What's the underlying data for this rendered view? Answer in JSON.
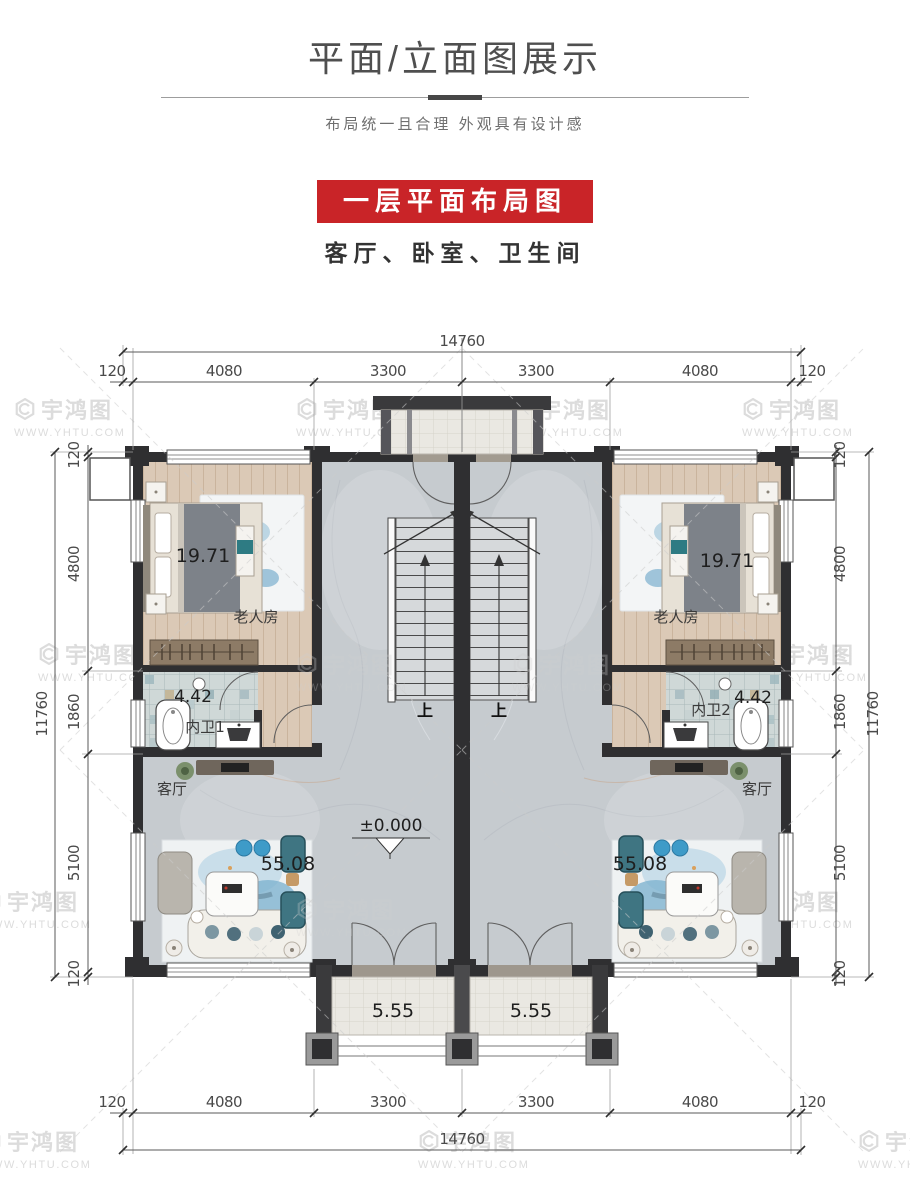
{
  "header": {
    "title": "平面/立面图展示",
    "subtitle": "布局统一且合理 外观具有设计感"
  },
  "banner": {
    "label": "一层平面布局图",
    "caption": "客厅、卧室、卫生间",
    "bg_color": "#c92428"
  },
  "watermark": {
    "brand": "宇鸿图",
    "url": "WWW.YHTU.COM"
  },
  "plan": {
    "dimensions": {
      "top_total": "14760",
      "top_segments": [
        "120",
        "4080",
        "3300",
        "3300",
        "4080",
        "120"
      ],
      "bottom_segments": [
        "120",
        "4080",
        "3300",
        "3300",
        "4080",
        "120"
      ],
      "bottom_total": "14760",
      "left_total": "11760",
      "left_segments": [
        "120",
        "4800",
        "1860",
        "5100",
        "120"
      ],
      "right_total": "11760",
      "right_segments": [
        "120",
        "4800",
        "1860",
        "5100",
        "120"
      ]
    },
    "rooms": {
      "bedroom_left": {
        "label": "老人房",
        "area": "19.71"
      },
      "bedroom_right": {
        "label": "老人房",
        "area": "19.71"
      },
      "bath_left": {
        "label": "内卫1",
        "area": "4.42"
      },
      "bath_right": {
        "label": "内卫2",
        "area": "4.42"
      },
      "living_left": {
        "label": "客厅",
        "area": "55.08"
      },
      "living_right": {
        "label": "客厅",
        "area": "55.08"
      },
      "porch_left": {
        "area": "5.55"
      },
      "porch_right": {
        "area": "5.55"
      }
    },
    "annotations": {
      "level": "±0.000",
      "up_left": "上",
      "up_right": "上"
    }
  }
}
